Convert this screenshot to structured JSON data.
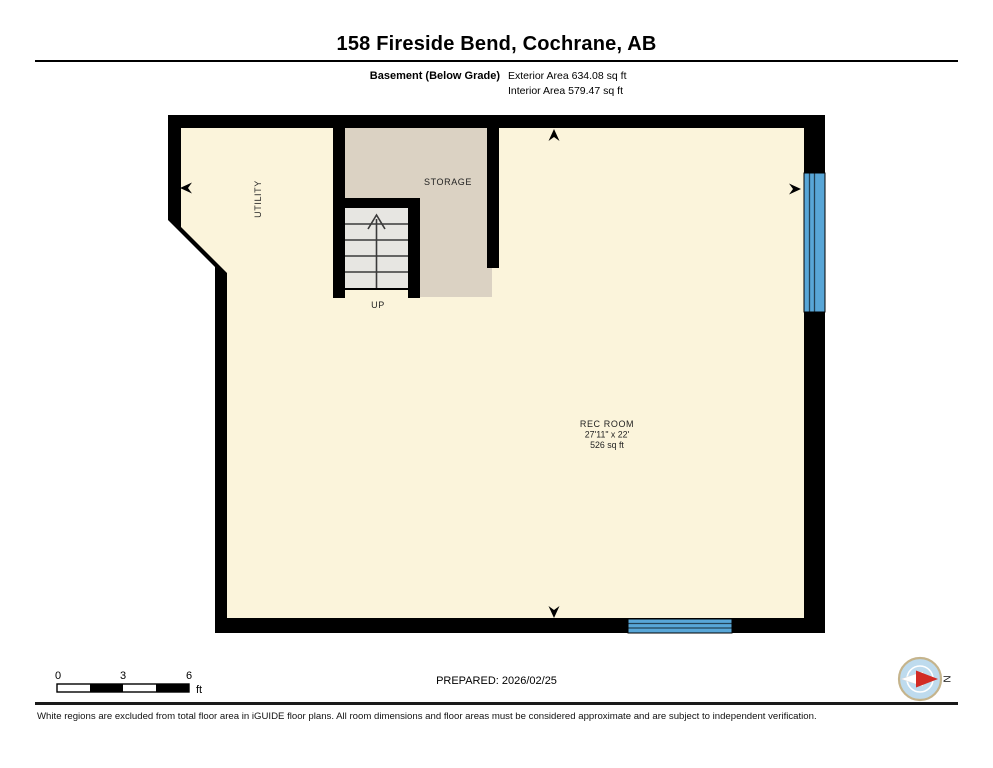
{
  "header": {
    "title": "158 Fireside Bend, Cochrane, AB",
    "floor_label": "Basement (Below Grade)",
    "exterior_area": "Exterior Area 634.08 sq ft",
    "interior_area": "Interior Area 579.47 sq ft"
  },
  "plan": {
    "rooms": {
      "utility": {
        "name": "UTILITY"
      },
      "storage": {
        "name": "STORAGE"
      },
      "rec_room": {
        "name": "REC ROOM",
        "dimensions": "27'11\" x 22'",
        "area": "526 sq ft"
      }
    },
    "stairs": {
      "label": "UP"
    },
    "colors": {
      "wall": "#000000",
      "interior_fill": "#FBF4DB",
      "storage_fill": "#DBD2C3",
      "stairs_fill": "#E7E6E2",
      "window_blue": "#58A6D7"
    }
  },
  "footer": {
    "scale_bar": {
      "ticks": [
        "0",
        "3",
        "6"
      ],
      "unit": "ft"
    },
    "prepared": "PREPARED: 2026/02/25",
    "compass": {
      "label": "N",
      "circle_blue": "#BEDBEE",
      "needle_red": "#D22B24",
      "ring_tan": "#C5B48C"
    },
    "disclaimer": "White regions are excluded from total floor area in iGUIDE floor plans. All room dimensions and floor areas must be considered approximate and are subject to independent verification."
  }
}
